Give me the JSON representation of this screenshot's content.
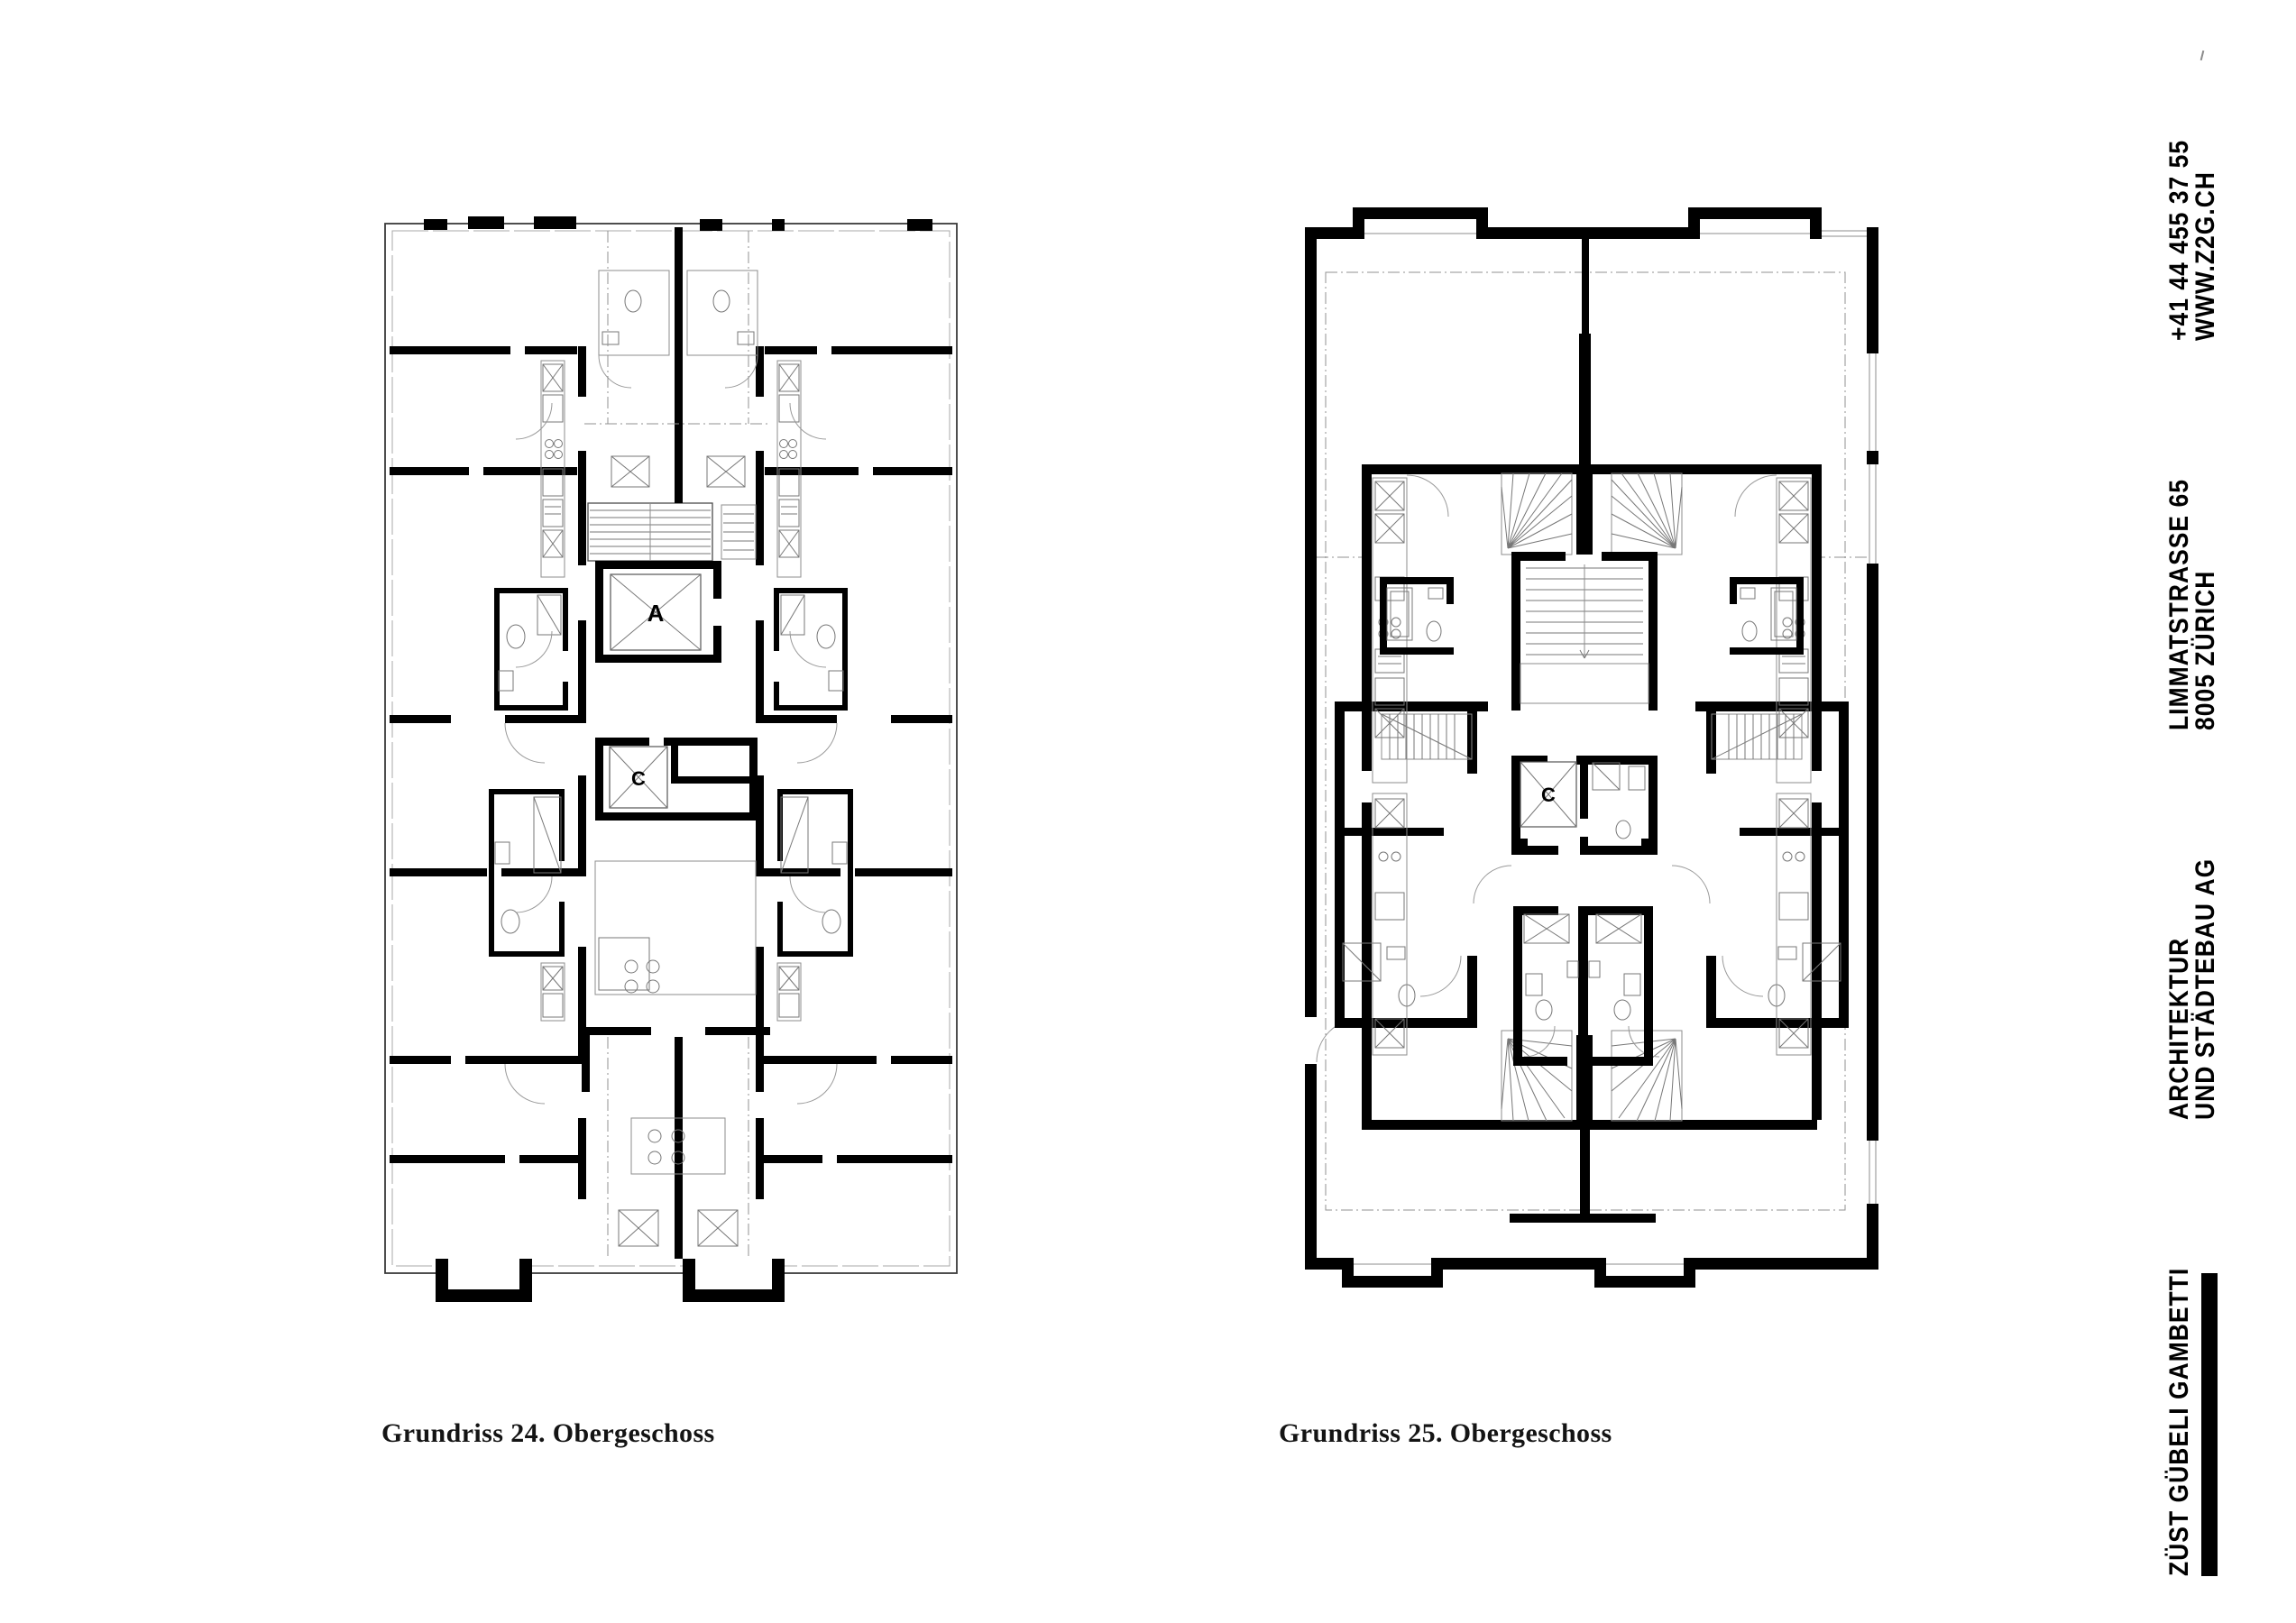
{
  "sheet": {
    "plans": [
      {
        "caption": "Grundriss 24. Obergeschoss",
        "labels": {
          "elevator_a": "A",
          "elevator_c": "C"
        }
      },
      {
        "caption": "Grundriss 25. Obergeschoss",
        "labels": {
          "elevator_c": "C"
        }
      }
    ],
    "sidebar": {
      "contact": {
        "line1": "+41 44 455 37 55",
        "line2": "WWW.Z2G.CH"
      },
      "address": {
        "line1": "LIMMATSTRASSE 65",
        "line2": "8005 ZÜRICH"
      },
      "firm_type": {
        "line1": "ARCHITEKTUR",
        "line2": "UND STÄDTEBAU AG"
      },
      "firm_name": "ZÜST GÜBELI GAMBETTI"
    },
    "colors": {
      "wall": "#000000",
      "thin_line": "#4a4a4a",
      "light_line": "#909090",
      "paper": "#ffffff",
      "text": "#141414"
    }
  }
}
